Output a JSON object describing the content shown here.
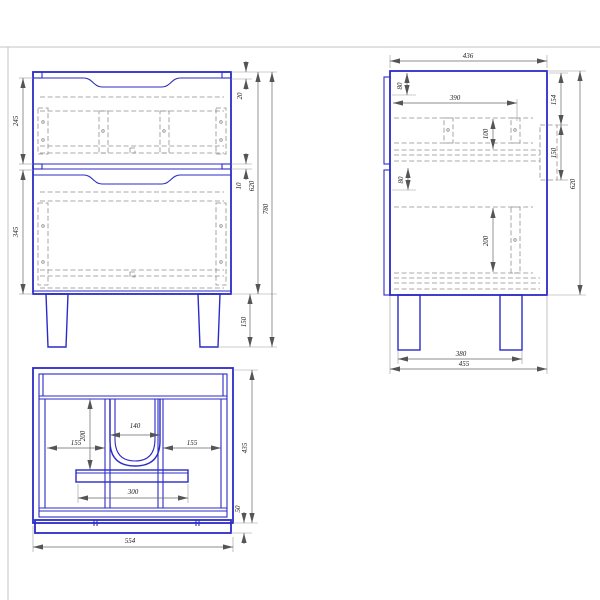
{
  "drawing_title": "cabinet-technical-drawing",
  "views": {
    "front": {
      "dim_drawer_top": "245",
      "dim_drawer_bottom": "345",
      "dim_top_recess": "20",
      "dim_gap": "10",
      "dim_body_height": "620",
      "dim_total_height": "780",
      "dim_leg_height": "150"
    },
    "side": {
      "dim_depth_top": "436",
      "dim_back_offset_top": "80",
      "dim_rail_length": "390",
      "dim_rail_height_top": "100",
      "dim_back_offset_mid": "80",
      "dim_rail_height_bottom": "200",
      "dim_top_margin": "154",
      "dim_bracket_height": "150",
      "dim_body_height": "620",
      "dim_leg_span": "380",
      "dim_depth_bottom": "455"
    },
    "plan": {
      "dim_left_bay": "155",
      "dim_center_depth": "200",
      "dim_cutout_width": "140",
      "dim_right_bay": "155",
      "dim_board_width": "300",
      "dim_total_width": "554",
      "dim_total_depth": "435",
      "dim_front_edge": "50"
    }
  },
  "colors": {
    "outline_blue": "#2b2bc8",
    "hidden_gray": "#8f8f8f",
    "dimension_gray": "#666666",
    "sheet_border_gray": "#c3c3c3",
    "background": "#ffffff"
  }
}
